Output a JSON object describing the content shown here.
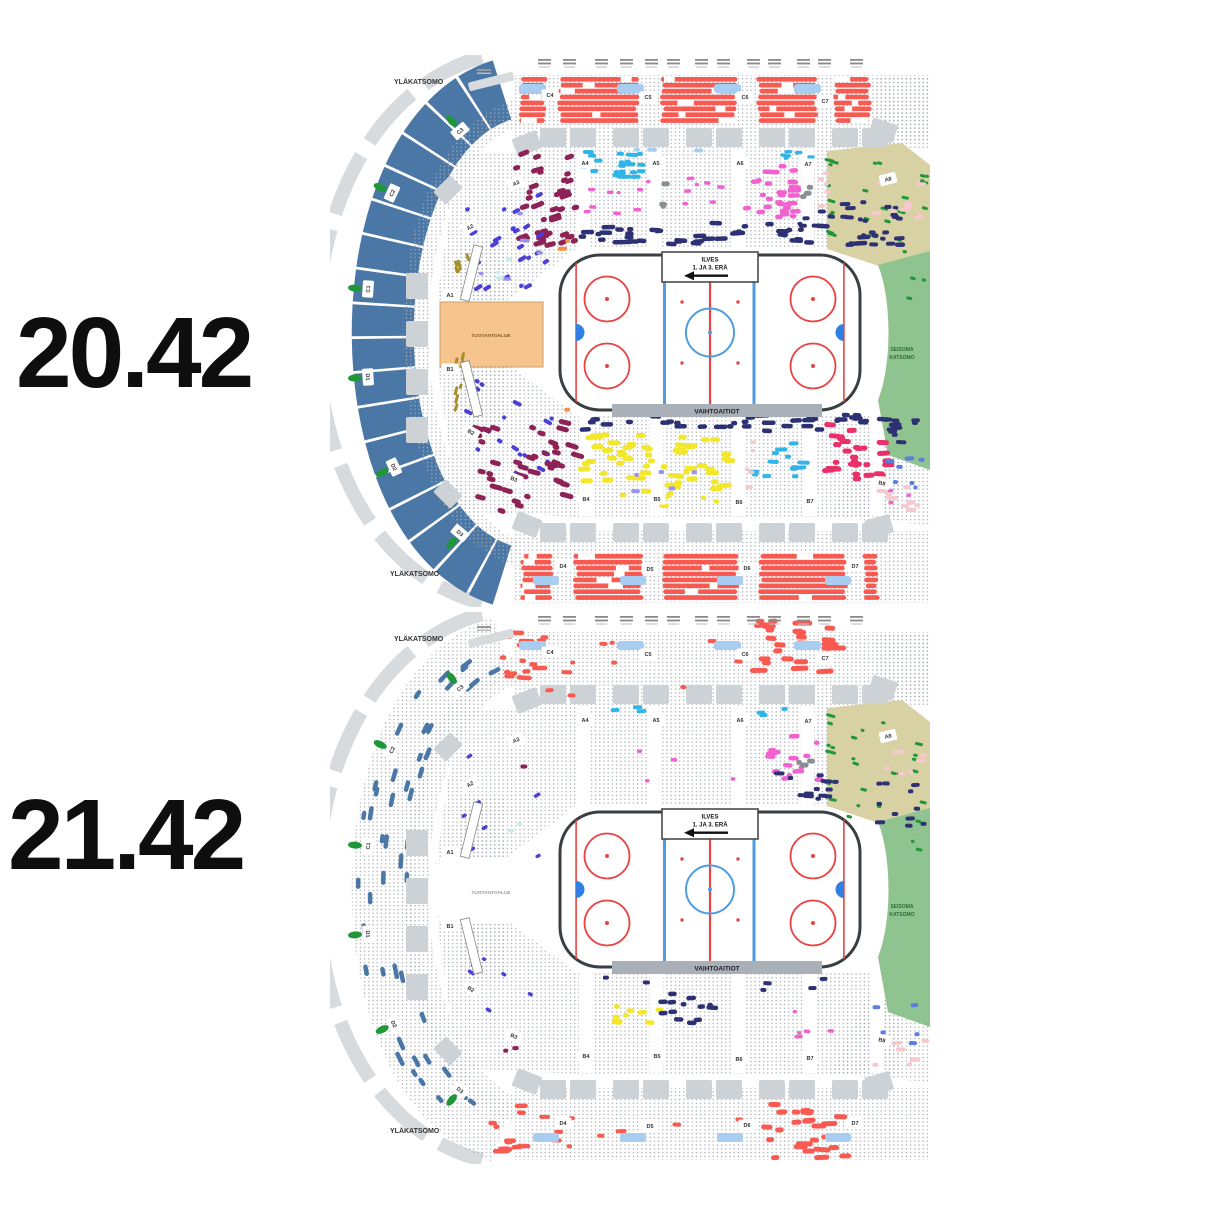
{
  "snapshots": [
    {
      "time": "20.42"
    },
    {
      "time": "21.42"
    }
  ],
  "arena": {
    "tier_label": "YLÄKATSOMO",
    "production_area_label": "TUOTANTOALUE",
    "standing_area_label_line1": "SEISOMA",
    "standing_area_label_line2": "KATSOMO",
    "rink": {
      "end_zone_line1": "ILVES",
      "end_zone_line2": "1. JA 3. ERÄ",
      "bench_label": "VAIHTOAITIOT"
    },
    "sections": {
      "outer_ring": [
        "C3",
        "C2",
        "C1",
        "D1",
        "D2",
        "D3"
      ],
      "upper_top": [
        "C4",
        "C5",
        "C6",
        "C7"
      ],
      "lower_top": [
        "A3",
        "A4",
        "A5",
        "A6",
        "A7",
        "A8"
      ],
      "inner_left": [
        "A2",
        "A1",
        "B1",
        "B2"
      ],
      "lower_bottom": [
        "B3",
        "B4",
        "B5",
        "B6",
        "B7",
        "B8"
      ],
      "upper_bottom": [
        "D4",
        "D5",
        "D6",
        "D7"
      ]
    }
  },
  "palette": {
    "background": "#ffffff",
    "time_text": "#0e0e0e",
    "outer_ring_blue": "#4a77a5",
    "walkway_gray": "#d8dbde",
    "block_gray": "#cdd2d7",
    "seat_dot": "#a7acb2",
    "band_red": "#f85a52",
    "sky_blue": "#a9cdf1",
    "maroon": "#8e2155",
    "magenta": "#f161cf",
    "navy": "#2d3174",
    "violet": "#4a3fd6",
    "light_violet": "#9a93ef",
    "cyan": "#31b5e9",
    "pale_cyan": "#c3ecf4",
    "yellow": "#f3e72b",
    "crimson": "#e93069",
    "green": "#1f9638",
    "olive": "#a58f2a",
    "khaki": "#d8d1a4",
    "rose": "#f5c9cd",
    "cornflower": "#5b7de0",
    "orange": "#f49044",
    "production_fill": "#f6c48d",
    "gray_patch": "#8a8f94",
    "rink_border": "#3a3f44",
    "rink_red": "#e84444",
    "rink_blue": "#4d9de0",
    "crease_blue": "#2f80e0",
    "bench_gray": "#aab0b7",
    "standing_green": "#8fc38f",
    "standing_text": "#2e6b3a",
    "label_text": "#333333"
  }
}
